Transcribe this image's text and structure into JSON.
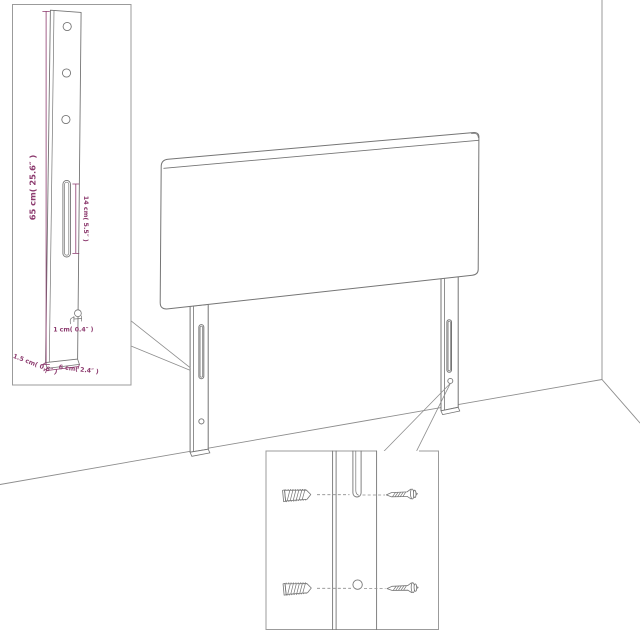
{
  "diagram": {
    "background": "#ffffff",
    "colors": {
      "artwork_line": "#757575",
      "scene_line": "#8d8d8d",
      "inset_border": "#9b9b9b",
      "dimension": "#8c3a6e"
    },
    "leg_detail": {
      "height_label": "65 cm( 25.6″ )",
      "slot_label": "14 cm( 5.5″ )",
      "hole_label": "1 cm( 0.4″ )",
      "thickness_label": "1.5 cm( 0.6″ )",
      "width_label": "6 cm( 2.4″ )"
    }
  }
}
